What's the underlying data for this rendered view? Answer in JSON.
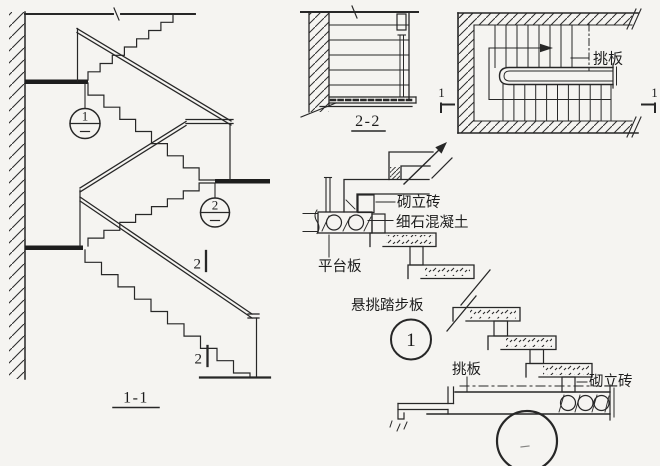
{
  "colors": {
    "ink": "#272727",
    "background": "#f5f4f1"
  },
  "sections": {
    "stair_section": {
      "title": "1-1",
      "callout_upper": "1",
      "callout_lower": "2",
      "cut_mark_upper": "2",
      "cut_mark_lower": "2"
    },
    "landing_section": {
      "title": "2-2"
    },
    "stair_plan": {
      "cantilever_label": "挑板",
      "cut_left": "1",
      "cut_right": "1"
    },
    "tread_detail": {
      "brick_label": "砌立砖",
      "concrete_label": "细石混凝土",
      "platform_label": "平台板",
      "tread_label": "悬挑踏步板",
      "bubble": "1"
    },
    "landing_detail": {
      "cantilever_label": "挑板",
      "brick_label": "砌立砖"
    }
  }
}
